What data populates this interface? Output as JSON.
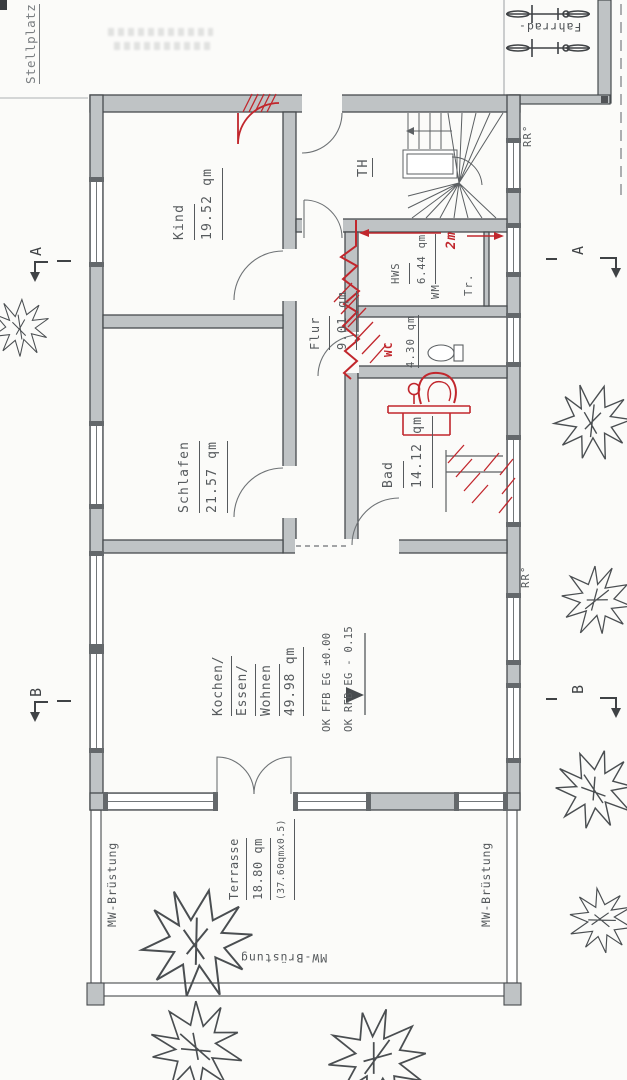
{
  "plan": {
    "site": {
      "stellplatz": "Stellplatz",
      "fahrrad": "Fahrrad-",
      "rr_top": "RR°",
      "rr_mid": "RR°"
    },
    "rooms": {
      "kind": {
        "name": "Kind",
        "area": "19.52 qm"
      },
      "schlafen": {
        "name": "Schlafen",
        "area": "21.57 qm"
      },
      "flur": {
        "name": "Flur",
        "area": "9.01 qm"
      },
      "treppenhaus": {
        "name": "TH"
      },
      "hauswirtschaft": {
        "name": "HWS",
        "area": "6.44 qm",
        "appliance_wm": "WM",
        "appliance_tr": "Tr."
      },
      "wc": {
        "name": "WC",
        "area": "4.30 qm"
      },
      "bad": {
        "name": "Bad",
        "area": "14.12 qm"
      },
      "wohnen": {
        "line1": "Kochen/",
        "line2": "Essen/",
        "line3": "Wohnen",
        "area": "49.98 qm"
      },
      "terrasse": {
        "name": "Terrasse",
        "area": "18.80 qm",
        "note": "(37.60qmx0.5)"
      }
    },
    "levels": {
      "ffb": "OK FFB EG ±0.00",
      "rfb": "OK RFB EG - 0.15"
    },
    "parapet": {
      "left": "MW-Brüstung",
      "right": "MW-Brüstung",
      "bottom": "MW-Brüstung"
    },
    "sections": {
      "a": "A",
      "b": "B"
    },
    "redline": {
      "dim": "2m"
    },
    "colors": {
      "wall_fill": "#bfc3c5",
      "line": "#474b4e",
      "red": "#c1272d",
      "text": "#565a5d"
    }
  }
}
